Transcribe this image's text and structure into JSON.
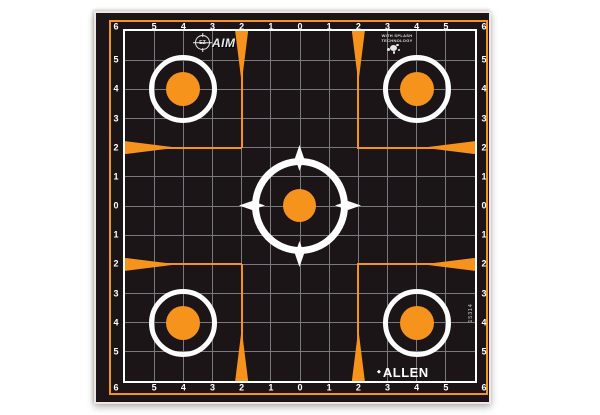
{
  "colors": {
    "paper": "#f3e4e4",
    "field_black": "#1b1518",
    "accent_orange": "#f6931d",
    "grid_line": "#7b7980",
    "marking_white": "#ffffff"
  },
  "grid": {
    "edge_labels": [
      "6",
      "5",
      "4",
      "3",
      "2",
      "1",
      "0",
      "1",
      "2",
      "3",
      "4",
      "5",
      "6"
    ]
  },
  "logos": {
    "ezaim": {
      "prefix": "EZ",
      "text": "AIM"
    },
    "splash": {
      "line1": "WITH SPLASH",
      "line2": "TECHNOLOGY"
    },
    "brand": {
      "mark": "◆",
      "name": "ALLEN"
    },
    "sku": "15314"
  }
}
